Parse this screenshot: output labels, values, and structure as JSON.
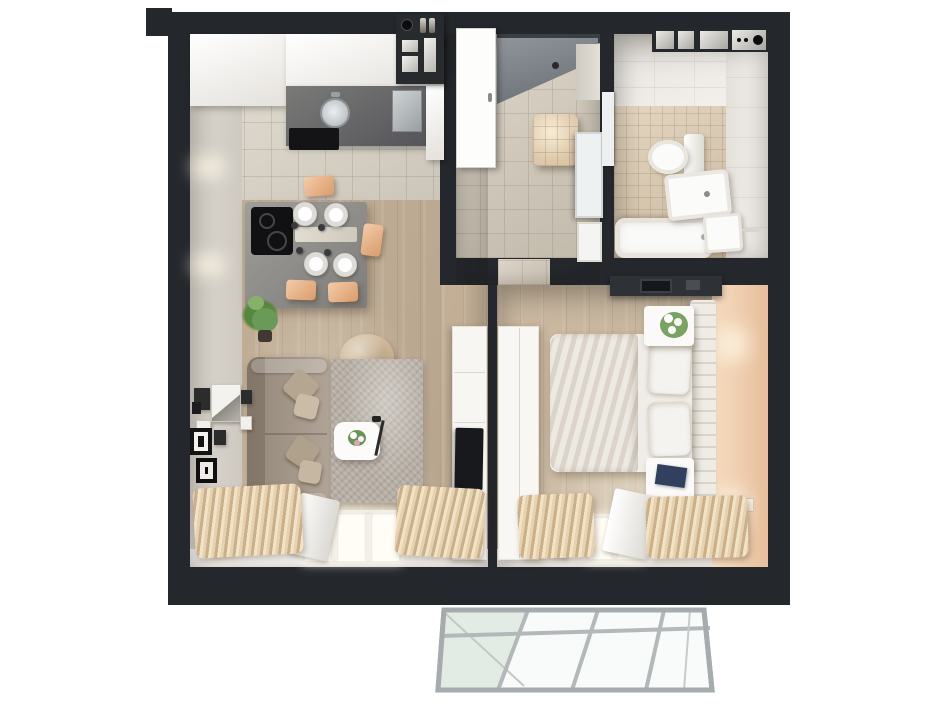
{
  "scene": {
    "description": "3D rendered top-down floor plan of a one-bedroom apartment",
    "background": "#ffffff",
    "wall_color": "#24272b",
    "window_light": "#fffdf6"
  },
  "rooms": {
    "living_kitchen": {
      "name": "Living room with open kitchen",
      "wood": "#cbb79d",
      "tile": "#ddd6c9",
      "wall_face": "#ddd8d0",
      "sill": "#f6f3ee"
    },
    "hallway": {
      "name": "Entrance hall",
      "tile": "#d2c9b9",
      "entry_door_gray": "#8f959b"
    },
    "bathroom": {
      "name": "Bathroom",
      "wall_tile": "#f2eee8",
      "floor_tile": "#dbc8ac"
    },
    "bedroom": {
      "name": "Bedroom",
      "wood": "#d5c2a9",
      "accent_wall": "#f6dcc1"
    },
    "balcony": {
      "name": "Glazed balcony",
      "frame": "#a6abad",
      "glass": "#f8fbf9",
      "glass_tint": "#e3ece4"
    }
  },
  "furniture": {
    "kitchen_cabinets": {
      "name": "White kitchen cabinets",
      "color": "#fbfaf7"
    },
    "countertop": {
      "name": "Dark countertop with sink",
      "color": "#6e6e6c"
    },
    "shelf_unit": {
      "name": "Open shelf unit with bottles",
      "color": "#282b2e"
    },
    "island": {
      "name": "Kitchen island dining table",
      "color": "#8f8e8a"
    },
    "cooktop": {
      "name": "Induction cooktop",
      "color": "#111113"
    },
    "dining_chairs": {
      "name": "Dining chairs",
      "color": "#f0b585",
      "count": 4
    },
    "plates": {
      "name": "Place settings",
      "color": "#ffffff",
      "count": 4
    },
    "plant": {
      "name": "Potted green plant",
      "color": "#6a9a57"
    },
    "beanbag": {
      "name": "Bean bag pouf",
      "color": "#d2bc9d"
    },
    "sofa": {
      "name": "Sofa with cushions",
      "color": "#a89a8b"
    },
    "rug": {
      "name": "Shaggy area rug",
      "color": "#b6aea4"
    },
    "coffee_table": {
      "name": "Coffee table with flowers",
      "color": "#fcfbf9"
    },
    "tv_unit": {
      "name": "TV cabinet",
      "color": "#f7f6f3",
      "tv_color": "#17191c"
    },
    "gallery_frames": {
      "name": "Gallery picture frames",
      "color": "#2c2c2c"
    },
    "curtains": {
      "name": "Beige pleated curtains",
      "color": "#e6d2b0"
    },
    "radiator": {
      "name": "Radiator shelf",
      "color": "#fbfaf7"
    },
    "entry_door": {
      "name": "Open entry door leaf",
      "color": "#fdfdfc"
    },
    "ottoman": {
      "name": "Quilted ottoman cube",
      "color": "#dcc7a8"
    },
    "mirror": {
      "name": "Hall mirror",
      "color": "#eef1f2"
    },
    "washer_shelf": {
      "name": "Bathroom shelf with washer",
      "color": "#26292c"
    },
    "bathtub": {
      "name": "Bathtub",
      "color": "#fafaf8"
    },
    "toilet": {
      "name": "Toilet",
      "color": "#fbfbfa"
    },
    "washbasin": {
      "name": "Washbasin cabinet",
      "color": "#fbfbfa"
    },
    "bath_cabinet": {
      "name": "Small bathroom cabinet",
      "color": "#fbfbfa"
    },
    "desk": {
      "name": "Desk with laptop",
      "color": "#2e3237"
    },
    "headboard": {
      "name": "Slatted headboard",
      "color": "#efece6"
    },
    "bed": {
      "name": "Double bed",
      "mattress": "#f0ede8",
      "duvet": "#e7e2da",
      "pillow": "#f5f3ef"
    },
    "nightstands": {
      "name": "Nightstands",
      "color": "#fbfaf8"
    },
    "book": {
      "name": "Book on nightstand",
      "color": "#31405e"
    },
    "bedroom_wardrobe": {
      "name": "White wardrobe",
      "color": "#f8f7f4"
    }
  }
}
